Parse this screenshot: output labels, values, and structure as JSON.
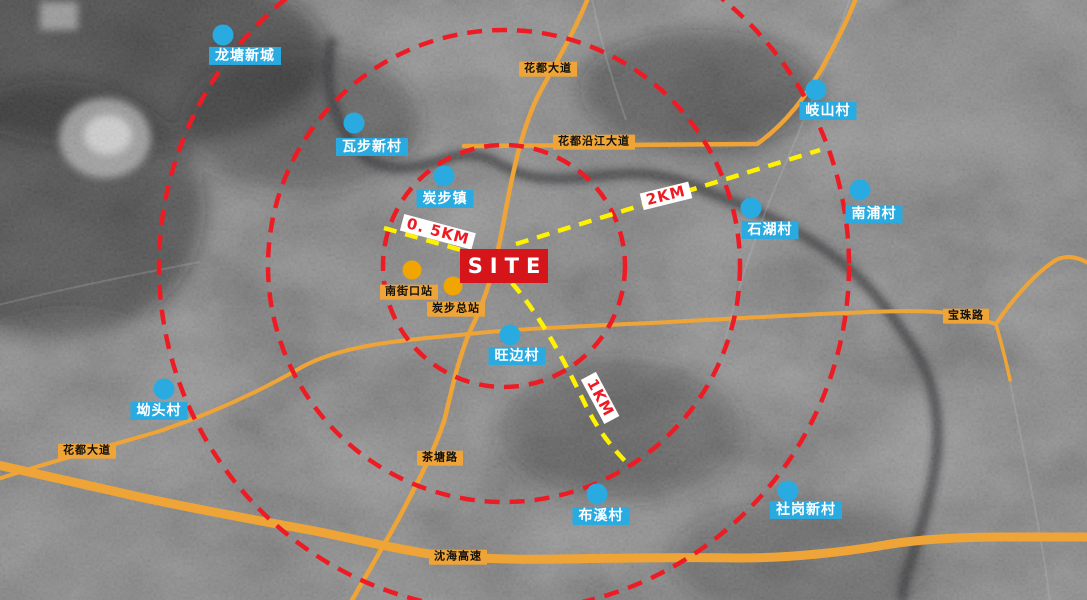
{
  "map": {
    "site_label": "SITE",
    "distance_labels": {
      "half_km": "0. 5KM",
      "one_km": "1KM",
      "two_km": "2KM"
    },
    "villages": [
      {
        "name": "龙塘新城"
      },
      {
        "name": "瓦步新村"
      },
      {
        "name": "炭步镇"
      },
      {
        "name": "岐山村"
      },
      {
        "name": "石湖村"
      },
      {
        "name": "南浦村"
      },
      {
        "name": "旺边村"
      },
      {
        "name": "坳头村"
      },
      {
        "name": "布溪村"
      },
      {
        "name": "社岗新村"
      }
    ],
    "stations": [
      {
        "name": "南街口站"
      },
      {
        "name": "炭步总站"
      }
    ],
    "roads": [
      {
        "name": "花都大道",
        "position": "top"
      },
      {
        "name": "花都沿江大道",
        "position": "upper-right"
      },
      {
        "name": "宝珠路",
        "position": "right"
      },
      {
        "name": "花都大道",
        "position": "left"
      },
      {
        "name": "茶塘路",
        "position": "bottom-center"
      },
      {
        "name": "沈海高速",
        "position": "bottom"
      }
    ],
    "colors": {
      "village_marker": "#29ABE2",
      "station_marker": "#F0A500",
      "road": "#EFA437",
      "ring": "#ED1C24",
      "distance_line": "#FFF200",
      "site_box": "#D6151B"
    }
  }
}
